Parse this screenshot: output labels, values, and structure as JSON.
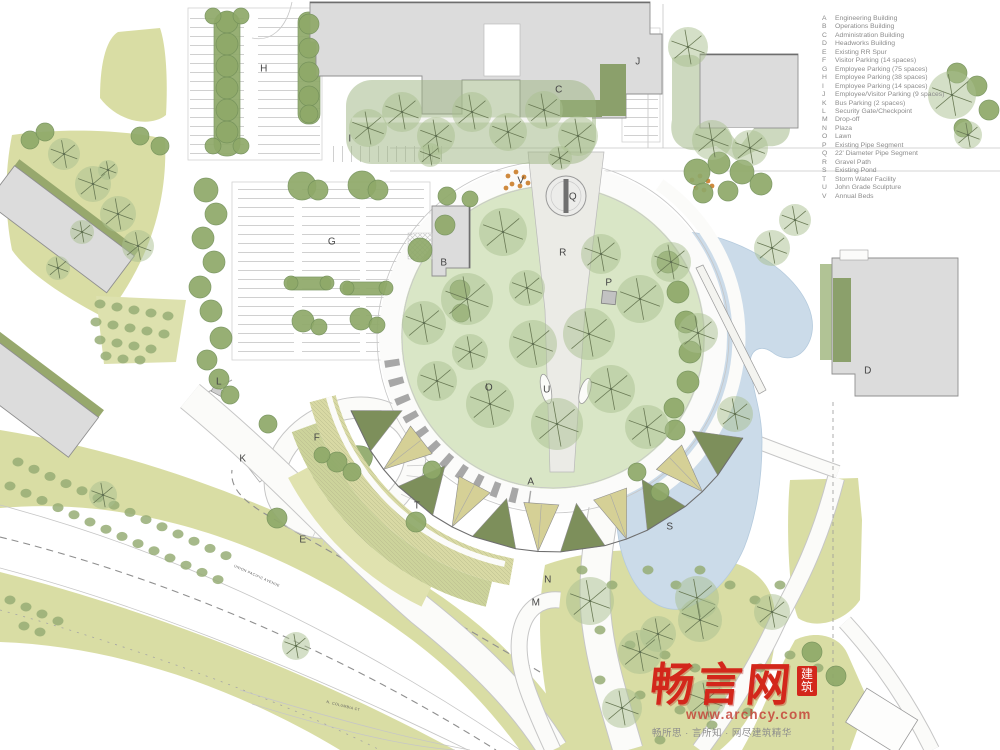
{
  "legend": {
    "items": [
      {
        "key": "A",
        "label": "Engineering Building"
      },
      {
        "key": "B",
        "label": "Operations Building"
      },
      {
        "key": "C",
        "label": "Administration Building"
      },
      {
        "key": "D",
        "label": "Headworks Building"
      },
      {
        "key": "E",
        "label": "Existing RR Spur"
      },
      {
        "key": "F",
        "label": "Visitor Parking (14 spaces)"
      },
      {
        "key": "G",
        "label": "Employee Parking (75 spaces)"
      },
      {
        "key": "H",
        "label": "Employee Parking (38 spaces)"
      },
      {
        "key": "I",
        "label": "Employee Parking (14 spaces)"
      },
      {
        "key": "J",
        "label": "Employee/Visitor Parking (9 spaces)"
      },
      {
        "key": "K",
        "label": "Bus Parking (2 spaces)"
      },
      {
        "key": "L",
        "label": "Security Gate/Checkpoint"
      },
      {
        "key": "M",
        "label": "Drop-off"
      },
      {
        "key": "N",
        "label": "Plaza"
      },
      {
        "key": "O",
        "label": "Lawn"
      },
      {
        "key": "P",
        "label": "Existing Pipe Segment"
      },
      {
        "key": "Q",
        "label": "22' Diameter Pipe Segment"
      },
      {
        "key": "R",
        "label": "Gravel Path"
      },
      {
        "key": "S",
        "label": "Existing Pond"
      },
      {
        "key": "T",
        "label": "Storm Water Facility"
      },
      {
        "key": "U",
        "label": "John Grade Sculpture"
      },
      {
        "key": "V",
        "label": "Annual Beds"
      }
    ]
  },
  "plan_labels": [
    {
      "key": "A",
      "x": 531,
      "y": 482
    },
    {
      "key": "B",
      "x": 444,
      "y": 263
    },
    {
      "key": "C",
      "x": 559,
      "y": 90
    },
    {
      "key": "D",
      "x": 868,
      "y": 371
    },
    {
      "key": "E",
      "x": 303,
      "y": 540
    },
    {
      "key": "F",
      "x": 317,
      "y": 438
    },
    {
      "key": "G",
      "x": 332,
      "y": 242
    },
    {
      "key": "H",
      "x": 264,
      "y": 69
    },
    {
      "key": "I",
      "x": 350,
      "y": 139
    },
    {
      "key": "J",
      "x": 638,
      "y": 62
    },
    {
      "key": "K",
      "x": 243,
      "y": 459
    },
    {
      "key": "L",
      "x": 219,
      "y": 382
    },
    {
      "key": "M",
      "x": 536,
      "y": 603
    },
    {
      "key": "N",
      "x": 548,
      "y": 580
    },
    {
      "key": "O",
      "x": 489,
      "y": 388
    },
    {
      "key": "P",
      "x": 609,
      "y": 283
    },
    {
      "key": "Q",
      "x": 573,
      "y": 197
    },
    {
      "key": "R",
      "x": 563,
      "y": 253
    },
    {
      "key": "S",
      "x": 670,
      "y": 527
    },
    {
      "key": "T",
      "x": 417,
      "y": 506
    },
    {
      "key": "U",
      "x": 547,
      "y": 390
    },
    {
      "key": "V",
      "x": 521,
      "y": 181
    }
  ],
  "road_labels": [
    {
      "text": "UNION PACIFIC AVENUE",
      "x": 232,
      "y": 574,
      "angle": 24
    },
    {
      "text": "N. COLUMBIA CT",
      "x": 326,
      "y": 704,
      "angle": 14
    }
  ],
  "watermark": {
    "logo": "畅言网",
    "badge": "建筑",
    "url": "www.archcy.com",
    "tagline": "畅所思 · 言所知 · 网尽建筑精华"
  },
  "colors": {
    "meadow": "#d9dda4",
    "meadow2": "#dde1ae",
    "lawn": "#d9e6c6",
    "canopy": "#a9bf90",
    "shrub": "#8fa969",
    "pond": "#cbdbe9",
    "building": "#dcdcdc",
    "roof_olive": "#7d8f5b",
    "roof_tan": "#d5d096",
    "accent_red": "#d3271b",
    "legend_text": "#8c8c8c",
    "letter": "#454545"
  }
}
